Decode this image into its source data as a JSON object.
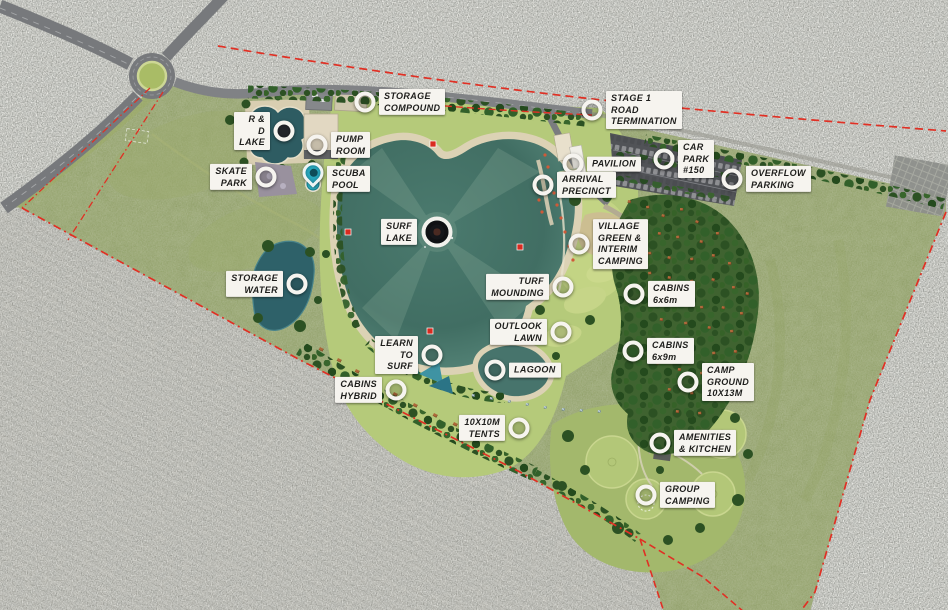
{
  "plan": {
    "markers": [
      {
        "label": "STORAGE COMPOUND",
        "x": 365,
        "y": 102,
        "side": "right",
        "type": "circle"
      },
      {
        "label": "STAGE 1 ROAD TERMINATION",
        "x": 592,
        "y": 110,
        "side": "right",
        "type": "circle"
      },
      {
        "label": "R & D LAKE",
        "x": 284,
        "y": 131,
        "side": "left",
        "type": "dark"
      },
      {
        "label": "PUMP ROOM",
        "x": 317,
        "y": 145,
        "side": "right",
        "type": "circle"
      },
      {
        "label": "SKATE PARK",
        "x": 266,
        "y": 177,
        "side": "left",
        "type": "circle"
      },
      {
        "label": "SCUBA POOL",
        "x": 313,
        "y": 177,
        "side": "right",
        "type": "pin"
      },
      {
        "label": "PAVILION",
        "x": 573,
        "y": 164,
        "side": "right",
        "type": "circle"
      },
      {
        "label": "CAR PARK #150",
        "x": 664,
        "y": 159,
        "side": "right",
        "type": "circle"
      },
      {
        "label": "ARRIVAL PRECINCT",
        "x": 543,
        "y": 185,
        "side": "right",
        "type": "circle"
      },
      {
        "label": "OVERFLOW PARKING",
        "x": 732,
        "y": 179,
        "side": "right",
        "type": "circle"
      },
      {
        "label": "SURF LAKE",
        "x": 437,
        "y": 232,
        "side": "left",
        "type": "target"
      },
      {
        "label": "VILLAGE GREEN &\nINTERIM CAMPING",
        "x": 579,
        "y": 244,
        "side": "right",
        "type": "circle"
      },
      {
        "label": "STORAGE WATER",
        "x": 297,
        "y": 284,
        "side": "left",
        "type": "circle"
      },
      {
        "label": "TURF MOUNDING",
        "x": 563,
        "y": 287,
        "side": "left",
        "type": "circle"
      },
      {
        "label": "CABINS 6x6m",
        "x": 634,
        "y": 294,
        "side": "right",
        "type": "circle"
      },
      {
        "label": "OUTLOOK LAWN",
        "x": 561,
        "y": 332,
        "side": "left",
        "type": "circle"
      },
      {
        "label": "CABINS 6x9m",
        "x": 633,
        "y": 351,
        "side": "right",
        "type": "circle"
      },
      {
        "label": "LEARN TO SURF",
        "x": 432,
        "y": 355,
        "side": "left",
        "type": "circle"
      },
      {
        "label": "LAGOON",
        "x": 495,
        "y": 370,
        "side": "right",
        "type": "circle"
      },
      {
        "label": "CAMP GROUND 10X13M",
        "x": 688,
        "y": 382,
        "side": "right",
        "type": "circle"
      },
      {
        "label": "CABINS HYBRID",
        "x": 396,
        "y": 390,
        "side": "left",
        "type": "circle"
      },
      {
        "label": "10X10M TENTS",
        "x": 519,
        "y": 428,
        "side": "left",
        "type": "circle"
      },
      {
        "label": "AMENITIES & KITCHEN",
        "x": 660,
        "y": 443,
        "side": "right",
        "type": "circle"
      },
      {
        "label": "GROUP CAMPING",
        "x": 646,
        "y": 495,
        "side": "right",
        "type": "circle"
      }
    ],
    "colors": {
      "boundary_red": "#e03024",
      "lake_teal": "#47706a",
      "pond_teal": "#2e5c62",
      "scuba_teal": "#2fb0c4",
      "beach_sand": "#dcd2b5",
      "site_green": "#8a9a60",
      "lawn_green": "#b9cf7e",
      "scrub_grey": "#7b7d76",
      "label_bg": "#f6f4ef",
      "label_text": "#1d1d1b"
    }
  }
}
